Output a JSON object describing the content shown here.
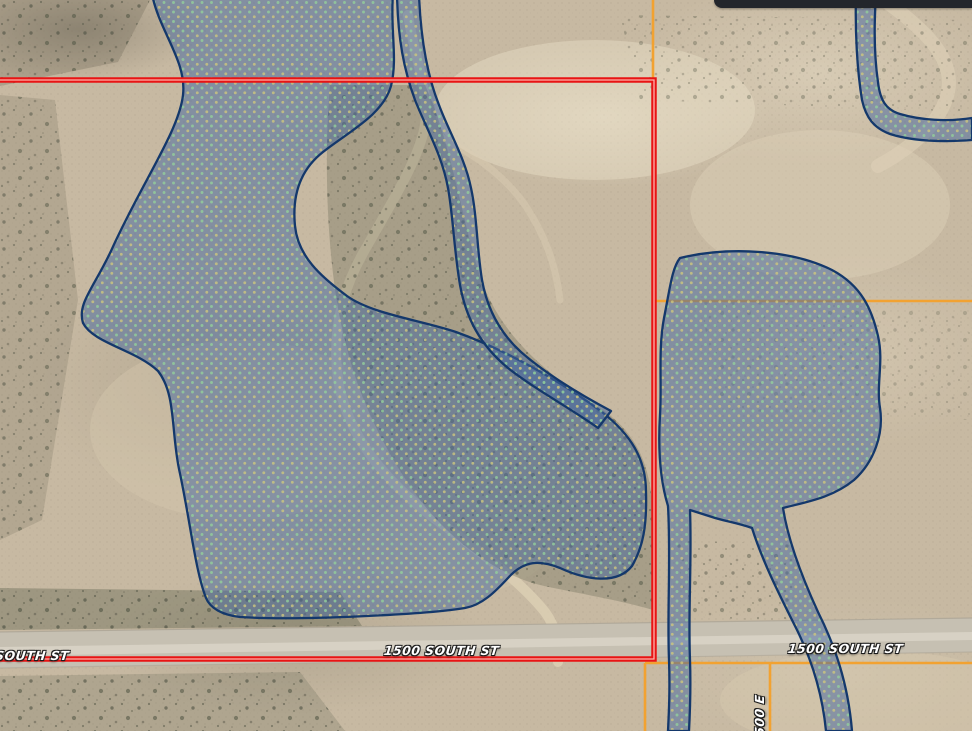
{
  "map": {
    "description": "aerial parcel viewer with wetland overlay",
    "road_labels": {
      "left_partial": "1500 SOUTH ST",
      "center": "1500 SOUTH ST",
      "right": "1500 SOUTH ST",
      "vertical_cross_street": "4500 E"
    },
    "overlays": {
      "selected_parcel_color": "#e81414",
      "selected_parcel_inner_stripe": "#ffb3ab",
      "parcel_line_color": "#f2a231",
      "wetland_fill": "#46689f",
      "wetland_outline": "#14386b",
      "wetland_dot_green": "#93cf9b",
      "wetland_dot_yellow": "#cdc77e"
    },
    "window_fragment": {
      "name": "dark-toolbar-edge",
      "color": "#23262c"
    }
  }
}
